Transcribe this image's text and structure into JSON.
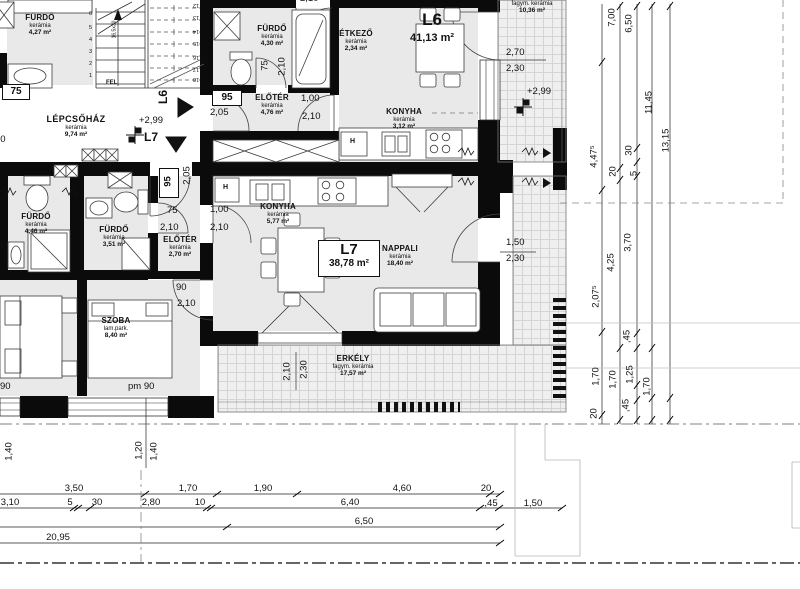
{
  "units": {
    "l6": {
      "label": "L6",
      "area": "41,13 m²"
    },
    "l7": {
      "label": "L7",
      "area": "38,78 m²"
    }
  },
  "levels": {
    "stair": "+2,99",
    "balcony": "+2,99"
  },
  "rooms": {
    "furdo_nw": {
      "name": "FÜRDŐ",
      "mat": "kerámia",
      "area": "4,27 m²"
    },
    "lepcsohaz": {
      "name": "LÉPCSŐHÁZ",
      "mat": "kerámia",
      "area": "9,74 m²"
    },
    "furdo_n": {
      "name": "FÜRDŐ",
      "mat": "kerámia",
      "area": "4,30 m²"
    },
    "eloter_n": {
      "name": "ELŐTÉR",
      "mat": "kerámia",
      "area": "4,76 m²"
    },
    "etkezo": {
      "name": "ÉTKEZŐ",
      "mat": "kerámia",
      "area": "2,34 m²"
    },
    "konyha_l6": {
      "name": "KONYHA",
      "mat": "kerámia",
      "area": "3,12 m²"
    },
    "erkely_l6": {
      "name": "ERKÉLY",
      "mat": "fagym. kerámia",
      "area": "10,36 m²"
    },
    "konyha_l7": {
      "name": "KONYHA",
      "mat": "kerámia",
      "area": "5,77 m²"
    },
    "nappali": {
      "name": "NAPPALI",
      "mat": "kerámia",
      "area": "18,40 m²"
    },
    "furdo_w": {
      "name": "FÜRDŐ",
      "mat": "kerámia",
      "area": "4,46 m²"
    },
    "furdo_m": {
      "name": "FÜRDŐ",
      "mat": "kerámia",
      "area": "3,51 m²"
    },
    "eloter_l7": {
      "name": "ELŐTÉR",
      "mat": "kerámia",
      "area": "2,70 m²"
    },
    "szoba": {
      "name": "SZOBA",
      "mat": "lam.park.",
      "area": "8,40 m²"
    },
    "erkely_l7": {
      "name": "ERKÉLY",
      "mat": "fagym. kerámia",
      "area": "17,57 m²"
    }
  },
  "stair": {
    "fel": "FEL",
    "note": "16,5x30",
    "l6": "L6",
    "l7": "L7",
    "lower": [
      "1",
      "2",
      "3",
      "4",
      "5",
      "6"
    ],
    "upper": [
      "12",
      "13",
      "14",
      "15",
      "16",
      "17",
      "18"
    ]
  },
  "doors": {
    "nw": {
      "w": "75",
      "h": "2,10"
    },
    "l6_entry": {
      "w": "95",
      "h": "2,05"
    },
    "n_furdo": {
      "w": "75",
      "h": "2,10"
    },
    "n_eloter": {
      "w": "1,00",
      "h": "2,10"
    },
    "top": {
      "h": "2,10"
    },
    "l6_balcony": {
      "w": "2,70",
      "h": "2,30"
    },
    "l7_entry": {
      "w": "95",
      "h": "2,05"
    },
    "m_furdo": {
      "w": "75",
      "h": "2,10"
    },
    "l7_konyha": {
      "w": "1,00",
      "h": "2,10"
    },
    "szoba": {
      "w": "90",
      "h": "2,10"
    },
    "l7_balcony": {
      "w": "1,50",
      "h": "2,30"
    },
    "erkely": {
      "w": "2,10",
      "h": "2,30"
    }
  },
  "windows": {
    "left": "90",
    "szoba": "pm 90"
  },
  "appliances": {
    "fridge": "H"
  },
  "dims": {
    "right": [
      "7,00",
      "6,50",
      "11,45",
      "13,15",
      "4,47⁵",
      "20",
      "30",
      "5",
      "4,25",
      "3,70",
      "2,07⁵",
      ",45",
      "1,70",
      "1,70",
      "1,25",
      "1,70",
      ",45",
      "20"
    ],
    "bottom": [
      "3,50",
      "1,70",
      "1,90",
      "4,60",
      "20",
      "3,10",
      "5",
      "30",
      "2,80",
      "10",
      "6,40",
      ",45",
      "1,50",
      "6,50",
      "20,95"
    ],
    "small": [
      "1,40",
      "1,20",
      "1,40"
    ]
  }
}
